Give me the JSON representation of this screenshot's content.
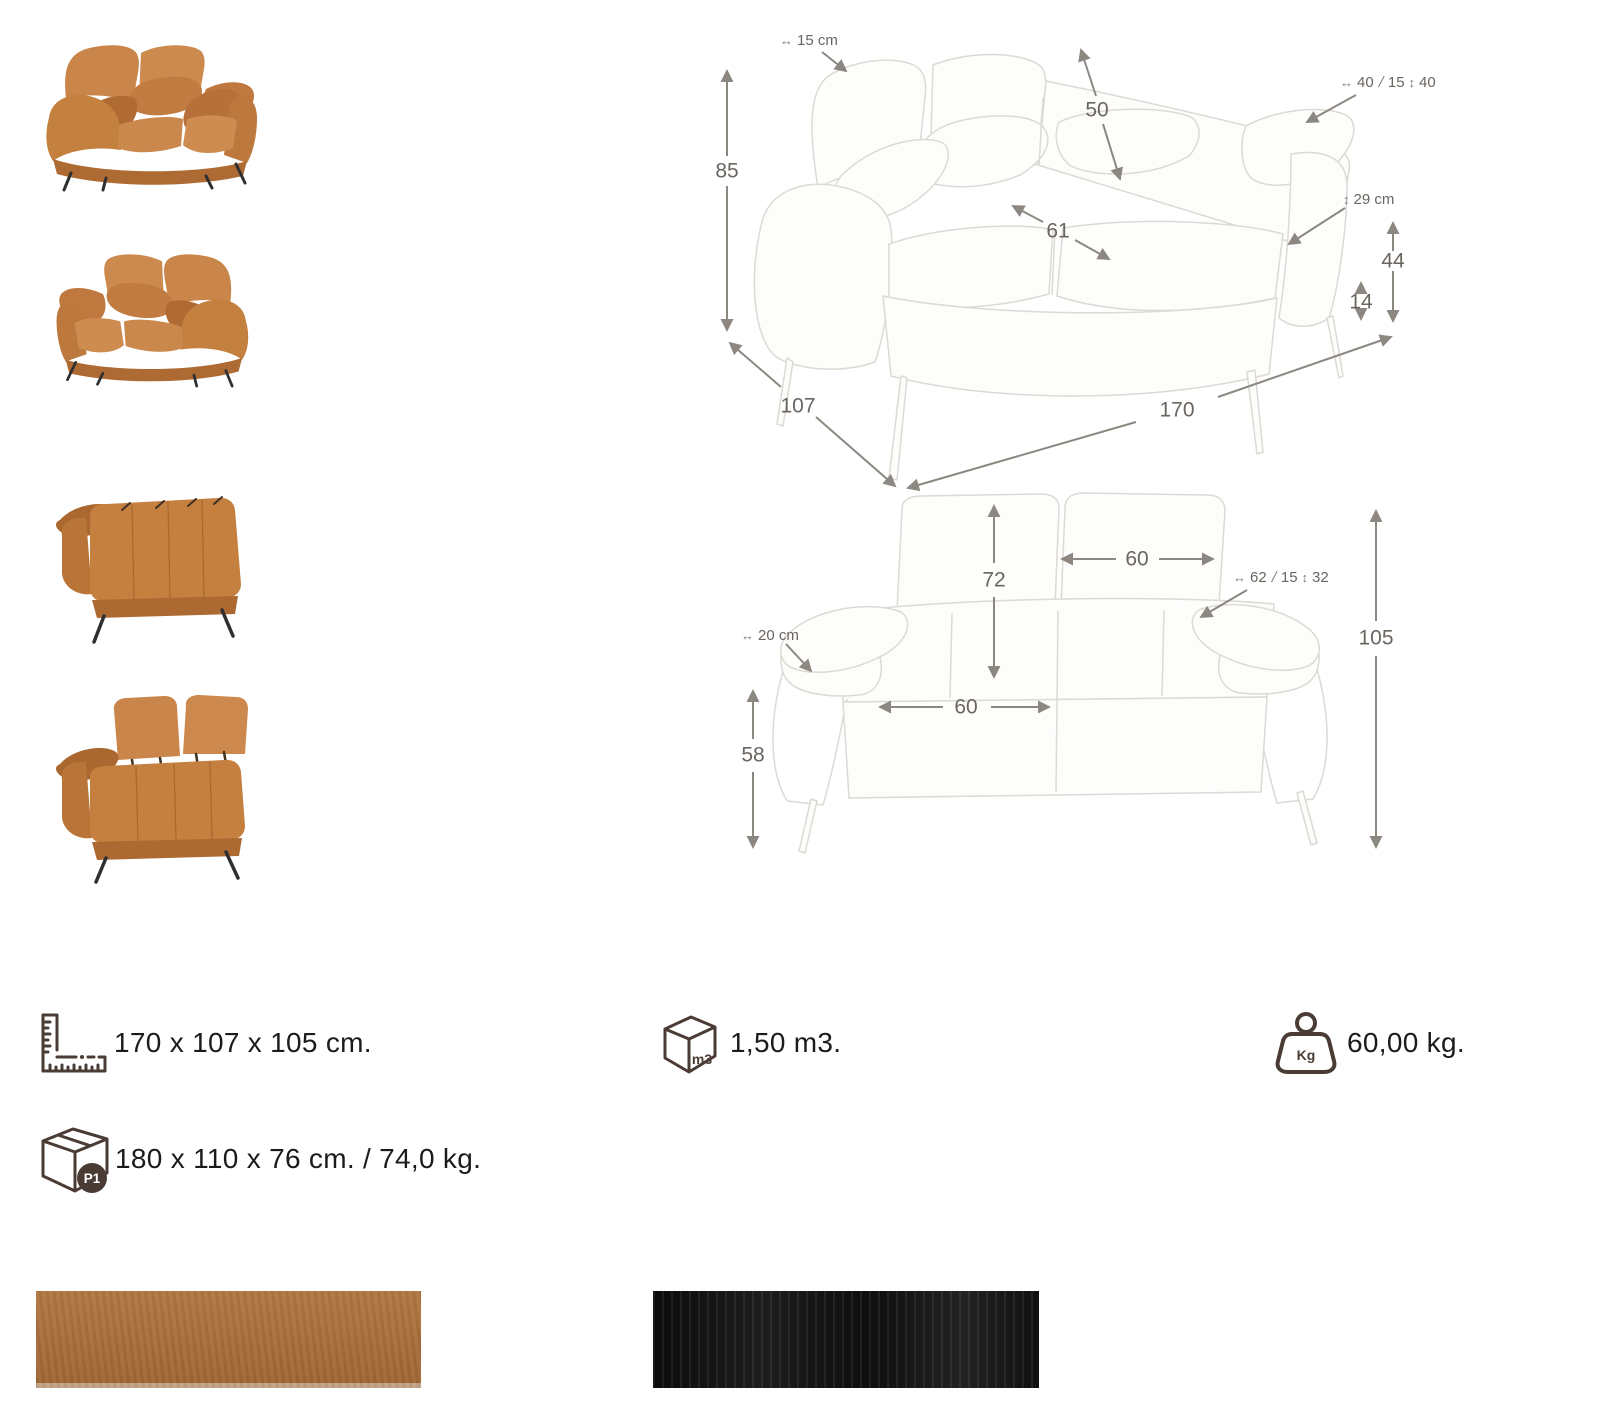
{
  "icons": {
    "h_arrow": "↔",
    "v_arrow": "↕",
    "diag_slash": "/",
    "cube_label": "m3",
    "weight_label": "Kg",
    "package_badge": "P1"
  },
  "diagrams": {
    "front": {
      "total_height": "85",
      "headrest_width": "15 cm",
      "backrest_height": "50",
      "pillow_width": "40",
      "pillow_depth": "15",
      "pillow_height": "40",
      "seat_depth": "61",
      "seat_back_height": "29 cm",
      "arm_height": "44",
      "leg_height": "14",
      "depth": "107",
      "width": "170"
    },
    "back": {
      "backrest_height": "72",
      "backrest_width": "60",
      "pillow_width": "62",
      "pillow_depth": "15",
      "pillow_height": "32",
      "arm_width": "20 cm",
      "total_height": "105",
      "arm_height": "58",
      "seat_width": "60"
    }
  },
  "specs": {
    "dimensions": "170 x 107 x 105 cm.",
    "volume": "1,50 m3.",
    "weight": "60,00 kg.",
    "package": "180 x 110 x 76 cm. / 74,0 kg."
  },
  "swatches": [
    {
      "name": "cognac leather",
      "color": "#ad6e38"
    },
    {
      "name": "black leather",
      "color": "#141414"
    }
  ],
  "palette": {
    "sketch_line": "#ddd9d3",
    "arrow": "#8c8781",
    "dim_text": "#6b6560",
    "icon_stroke": "#4a3c34",
    "sofa_body": "#c5803f"
  }
}
